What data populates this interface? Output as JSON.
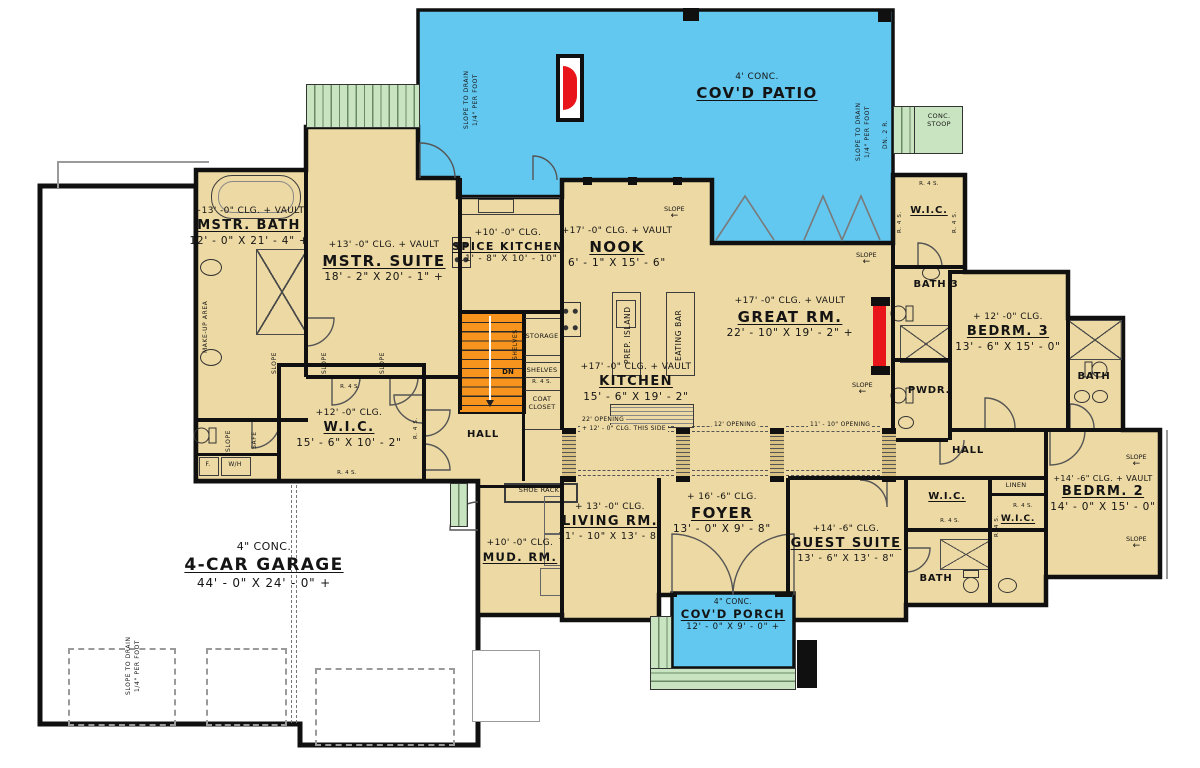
{
  "title": "First floor plan",
  "colors": {
    "room_fill": "#EDD9A3",
    "patio_blue": "#63C8F0",
    "step_green": "#C9E4C0",
    "stair_orange": "#F6941D",
    "fireplace_red": "#E8151B",
    "wall_black": "#101010"
  },
  "rooms": {
    "patio": {
      "note": "4' CONC.",
      "name": "COV'D PATIO"
    },
    "porch": {
      "note": "4\" CONC.",
      "name": "COV'D PORCH",
      "dims": "12' - 0\" X 9' - 0\" +"
    },
    "garage": {
      "note": "4\" CONC.",
      "name": "4-CAR GARAGE",
      "dims": "44' - 0\" X 24' - 0\" +"
    },
    "mstr_bath": {
      "note": "+13' -0\" CLG. + VAULT",
      "name": "MSTR. BATH",
      "dims": "12' - 0\" X 21' - 4\" +"
    },
    "mstr_suite": {
      "note": "+13' -0\" CLG. + VAULT",
      "name": "MSTR. SUITE",
      "dims": "18' - 2\" X 20' - 1\" +"
    },
    "wic_master": {
      "note": "+12' -0\" CLG.",
      "name": "W.I.C.",
      "dims": "15' - 6\" X 10' - 2\""
    },
    "spice_kitchen": {
      "note": "+10' -0\" CLG.",
      "name": "SPICE KITCHEN",
      "dims": "11' - 8\" X 10' - 10\""
    },
    "nook": {
      "note": "+17' -0\" CLG. + VAULT",
      "name": "NOOK",
      "dims": "6' - 1\" X 15' - 6\""
    },
    "kitchen": {
      "note": "+17' -0\" CLG. + VAULT",
      "name": "KITCHEN",
      "dims": "15' - 6\" X 19' - 2\""
    },
    "great_rm": {
      "note": "+17' -0\" CLG. + VAULT",
      "name": "GREAT RM.",
      "dims": "22' - 10\" X 19' - 2\" +"
    },
    "hall_center": {
      "name": "HALL"
    },
    "hall_right": {
      "name": "HALL"
    },
    "mud_rm": {
      "note": "+10' -0\" CLG.",
      "name": "MUD. RM."
    },
    "living_rm": {
      "note": "+ 13' -0\" CLG.",
      "name": "LIVING RM.",
      "dims": "11' - 10\" X 13' - 8\""
    },
    "foyer": {
      "note": "+ 16' -6\" CLG.",
      "name": "FOYER",
      "dims": "13' - 0\" X 9' - 8\""
    },
    "guest_suite": {
      "note": "+14' -6\" CLG.",
      "name": "GUEST SUITE",
      "dims": "13' - 6\" X 13' - 8\""
    },
    "guest_wic": {
      "name": "W.I.C."
    },
    "guest_bath": {
      "name": "BATH"
    },
    "linen": {
      "name": "LINEN"
    },
    "wic_bedrm2": {
      "name": "W.I.C."
    },
    "bedrm2": {
      "note": "+14' -6\" CLG. + VAULT",
      "name": "BEDRM. 2",
      "dims": "14' - 0\" X 15' - 0\""
    },
    "bedrm3": {
      "note": "+ 12' -0\" CLG.",
      "name": "BEDRM. 3",
      "dims": "13' - 6\" X 15' - 0\""
    },
    "bath3": {
      "name": "BATH 3"
    },
    "pwdr": {
      "name": "PWDR."
    },
    "wic_top_right": {
      "name": "W.I.C."
    },
    "bath_right": {
      "name": "BATH"
    },
    "stoop": {
      "name": "CONC. STOOP"
    }
  },
  "annotations": {
    "slope_to_drain": "SLOPE TO DRAIN",
    "per_foot": "1/4\" PER FOOT",
    "dn_2r": "DN. 2 R.",
    "slope": "SLOPE",
    "arrow_left": "←",
    "dn": "DN",
    "r4s": "R. 4 S.",
    "make_up_area": "MAKE-UP AREA",
    "prep_island": "PREP. ISLAND",
    "eating_bar": "EATING BAR",
    "shoe_rack": "SHOE RACK",
    "coat_closet": "COAT CLOSET",
    "storage": "STORAGE",
    "shelves": "SHELVES",
    "safe": "SAFE",
    "furnace": "F.",
    "water_heater": "W/H",
    "opening_22": "22' OPENING",
    "clg_this_side": "+ 12' - 0\" CLG. THIS SIDE",
    "opening_12": "12' OPENING",
    "opening_11_10": "11' - 10\" OPENING"
  }
}
